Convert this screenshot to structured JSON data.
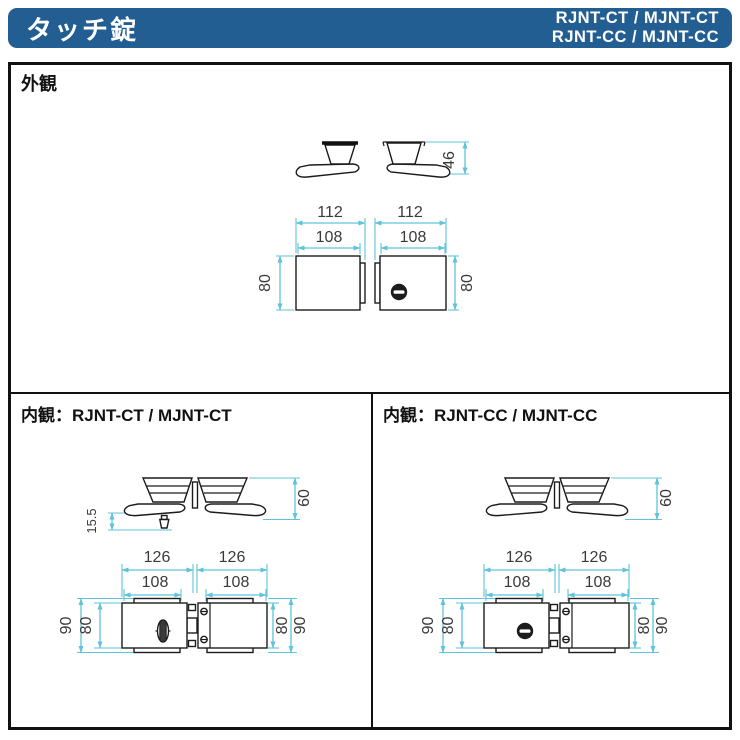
{
  "header": {
    "title": "タッチ錠",
    "models_line1": "RJNT-CT / MJNT-CT",
    "models_line2": "RJNT-CC / MJNT-CC"
  },
  "sections": {
    "exterior": {
      "label": "外観",
      "dims": {
        "lever_height": "46",
        "width_outer": "112",
        "width_inner": "108",
        "case_height": "80"
      }
    },
    "interior_ct": {
      "label": "内観：RJNT-CT / MJNT-CT",
      "dims": {
        "lever_height": "60",
        "button_length": "15.5",
        "width_outer": "126",
        "width_inner": "108",
        "height_outer": "90",
        "case_height": "80"
      }
    },
    "interior_cc": {
      "label": "内観：RJNT-CC / MJNT-CC",
      "dims": {
        "lever_height": "60",
        "width_outer": "126",
        "width_inner": "108",
        "height_outer": "90",
        "case_height": "80"
      }
    }
  },
  "colors": {
    "header_bg": "#235e93",
    "dimension_line": "#5fc3d9",
    "dimension_text": "#3a3a3a",
    "outline": "#1c1c1c"
  }
}
